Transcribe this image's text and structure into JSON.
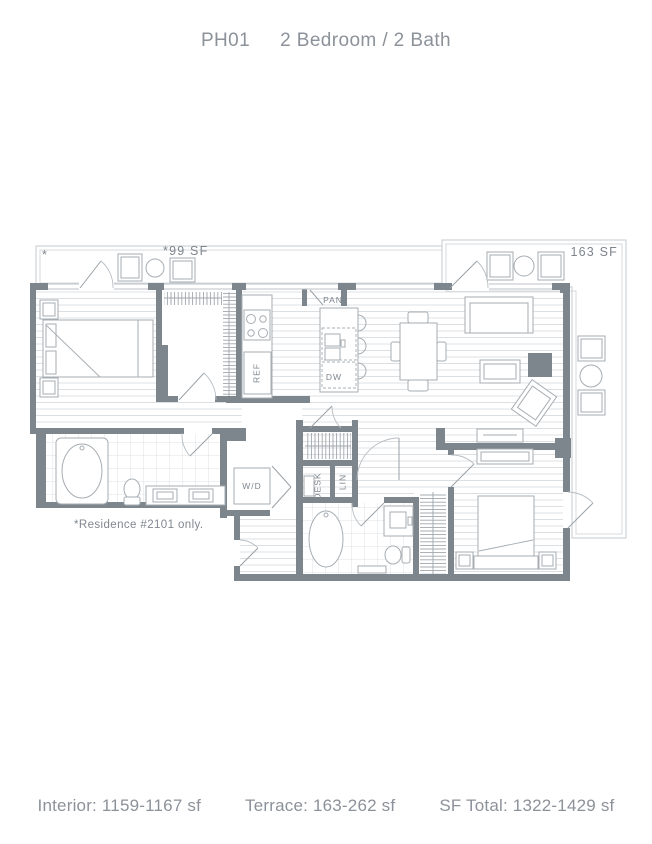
{
  "header": {
    "unit_code": "PH01",
    "unit_type": "2 Bedroom / 2 Bath"
  },
  "floor_plan": {
    "terrace_left": {
      "area_label": "*99 SF",
      "corner_mark": "*"
    },
    "terrace_right": {
      "area_label": "163 SF"
    },
    "kitchen": {
      "pantry": "PAN",
      "refrigerator": "REF",
      "dishwasher": "DW"
    },
    "utility": {
      "washer_dryer": "W/D",
      "desk": "DESK",
      "linen": "LIN"
    },
    "note": "*Residence #2101 only."
  },
  "footer": {
    "interior": "Interior: 1159-1167 sf",
    "terrace": "Terrace: 163-262 sf",
    "sf_total": "SF Total: 1322-1429 sf"
  },
  "colors": {
    "wall": "#7e868d",
    "floor_line": "#dce0e3",
    "furniture_line": "#a6adb3",
    "label_text": "#7d858d",
    "heading_text": "#8c929a",
    "accent_square": "#7e868d"
  }
}
